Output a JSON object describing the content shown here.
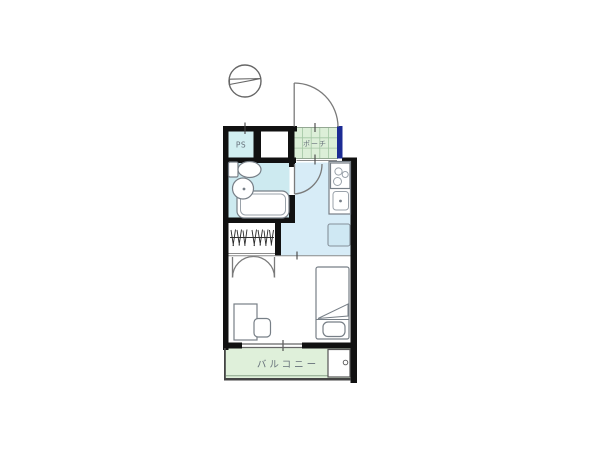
{
  "floorplan": {
    "labels": {
      "pipe_space": "PS",
      "porch": "ポーチ",
      "balcony": "バルコニー"
    },
    "colors": {
      "wall": "#111111",
      "ps_floor": "#d2eff1",
      "bathroom_floor": "#cdeaf0",
      "kitchen_floor": "#d7ecf7",
      "porch_floor": "#dcefd8",
      "balcony_floor": "#dff0da",
      "entrance_accent": "#1c2b94",
      "appliance_space_fill": "#cfe8f3"
    },
    "symbols": [
      {
        "name": "north-arrow",
        "shape": "circle-with-needle"
      },
      {
        "name": "entrance-gate-door",
        "type": "swing-door"
      },
      {
        "name": "unit-entry-door",
        "type": "swing-door"
      },
      {
        "name": "closet-double-doors",
        "type": "double-swing-door"
      }
    ],
    "fixtures": [
      "toilet",
      "washbasin",
      "bathtub",
      "stove-3-burners",
      "kitchen-sink",
      "appliance-space",
      "closet-hanger-rod",
      "desk",
      "chair",
      "bed",
      "pillow",
      "window",
      "washing-machine-pan"
    ]
  }
}
